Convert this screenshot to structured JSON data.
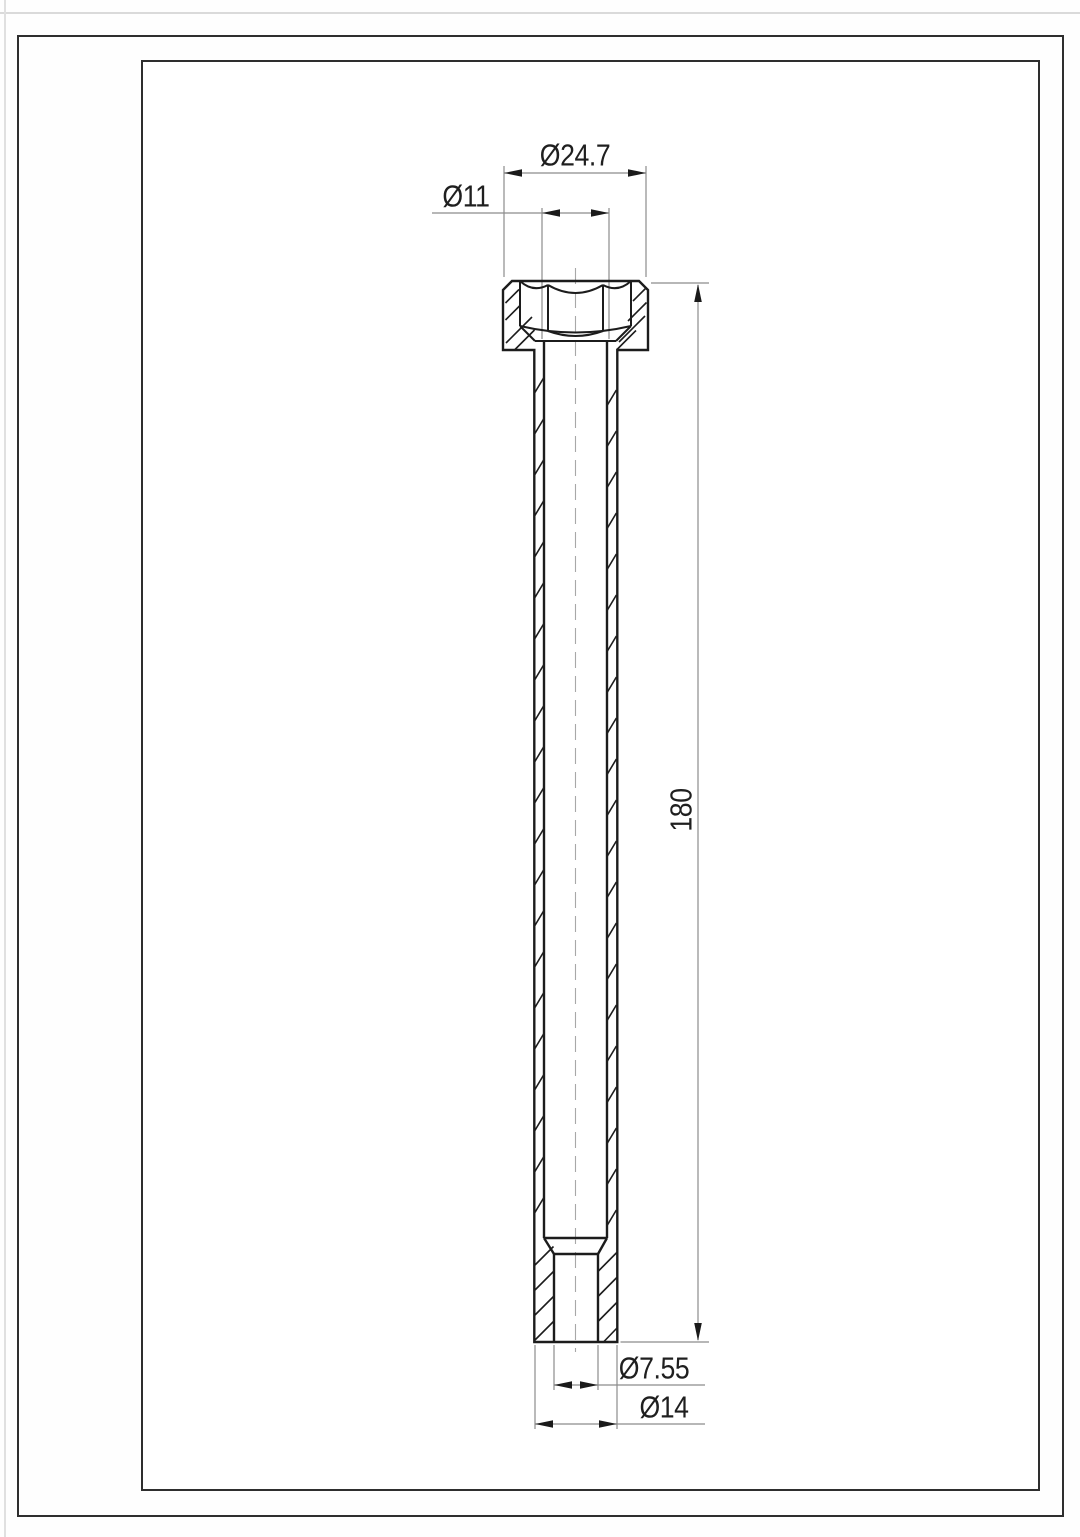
{
  "drawing": {
    "dims": {
      "head_diameter": "Ø24.7",
      "bore_diameter": "Ø11",
      "overall_length": "180",
      "tip_bore_diameter": "Ø7.55",
      "tip_outer_diameter": "Ø14"
    },
    "colors": {
      "object_line": "#1c1c1c",
      "thin_line": "#8c8c8c",
      "centerline": "#a8a8a8",
      "text": "#1f1f1f",
      "frame": "#2e2e2e",
      "background": "#ffffff"
    }
  }
}
